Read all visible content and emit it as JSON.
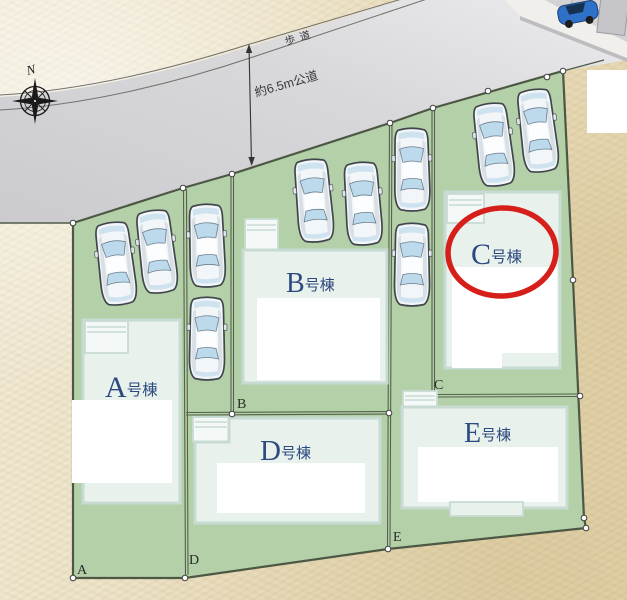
{
  "compass": {
    "north_label": "N"
  },
  "road": {
    "sidewalk_label": "歩道",
    "width_label": "約6.5m公道"
  },
  "plots": [
    {
      "id": "A",
      "building_label": {
        "letter": "A",
        "suffix": "号棟"
      },
      "corner_label": "A",
      "highlighted": false
    },
    {
      "id": "B",
      "building_label": {
        "letter": "B",
        "suffix": "号棟"
      },
      "corner_label": "B",
      "highlighted": false
    },
    {
      "id": "C",
      "building_label": {
        "letter": "C",
        "suffix": "号棟"
      },
      "corner_label": "C",
      "highlighted": true
    },
    {
      "id": "D",
      "building_label": {
        "letter": "D",
        "suffix": "号棟"
      },
      "corner_label": "D",
      "highlighted": false
    },
    {
      "id": "E",
      "building_label": {
        "letter": "E",
        "suffix": "号棟"
      },
      "corner_label": "E",
      "highlighted": false
    }
  ],
  "highlight": {
    "shape": "red-circle",
    "plot": "C"
  },
  "parking": {
    "car_count": 10
  },
  "colors": {
    "background_paper": "#ece1c6",
    "road_gray": "#d6d6da",
    "plot_green": "#b4d0a9",
    "boundary": "#4f5b47",
    "building_fill": "#e9f1ed",
    "building_border": "#c8dbd3",
    "label_navy": "#2d4a80",
    "highlight_red": "#d61f1a"
  }
}
